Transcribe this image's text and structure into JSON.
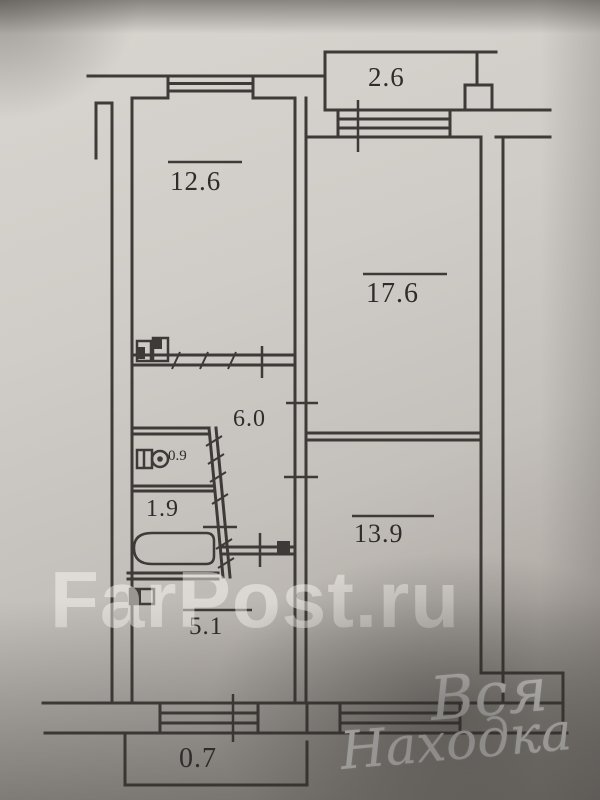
{
  "plan": {
    "title": "apartment-floor-plan-scan",
    "rooms": [
      {
        "name": "balcony-top",
        "area": "2.6"
      },
      {
        "name": "kitchen",
        "area": "12.6"
      },
      {
        "name": "living-room",
        "area": "17.6"
      },
      {
        "name": "corridor",
        "area": "6.0"
      },
      {
        "name": "toilet",
        "area": "0.9"
      },
      {
        "name": "bathroom",
        "area": "1.9"
      },
      {
        "name": "bedroom",
        "area": "13.9"
      },
      {
        "name": "hallway",
        "area": "5.1"
      },
      {
        "name": "balcony-bottom",
        "area": "0.7"
      }
    ]
  },
  "watermarks": {
    "site": "FarPost.ru",
    "signature_line1": "Вся",
    "signature_line2": "Находка"
  },
  "colors": {
    "ink": "#3e3a37",
    "paper": "#cdc9c4",
    "watermark_white": "#fbfaf7"
  }
}
